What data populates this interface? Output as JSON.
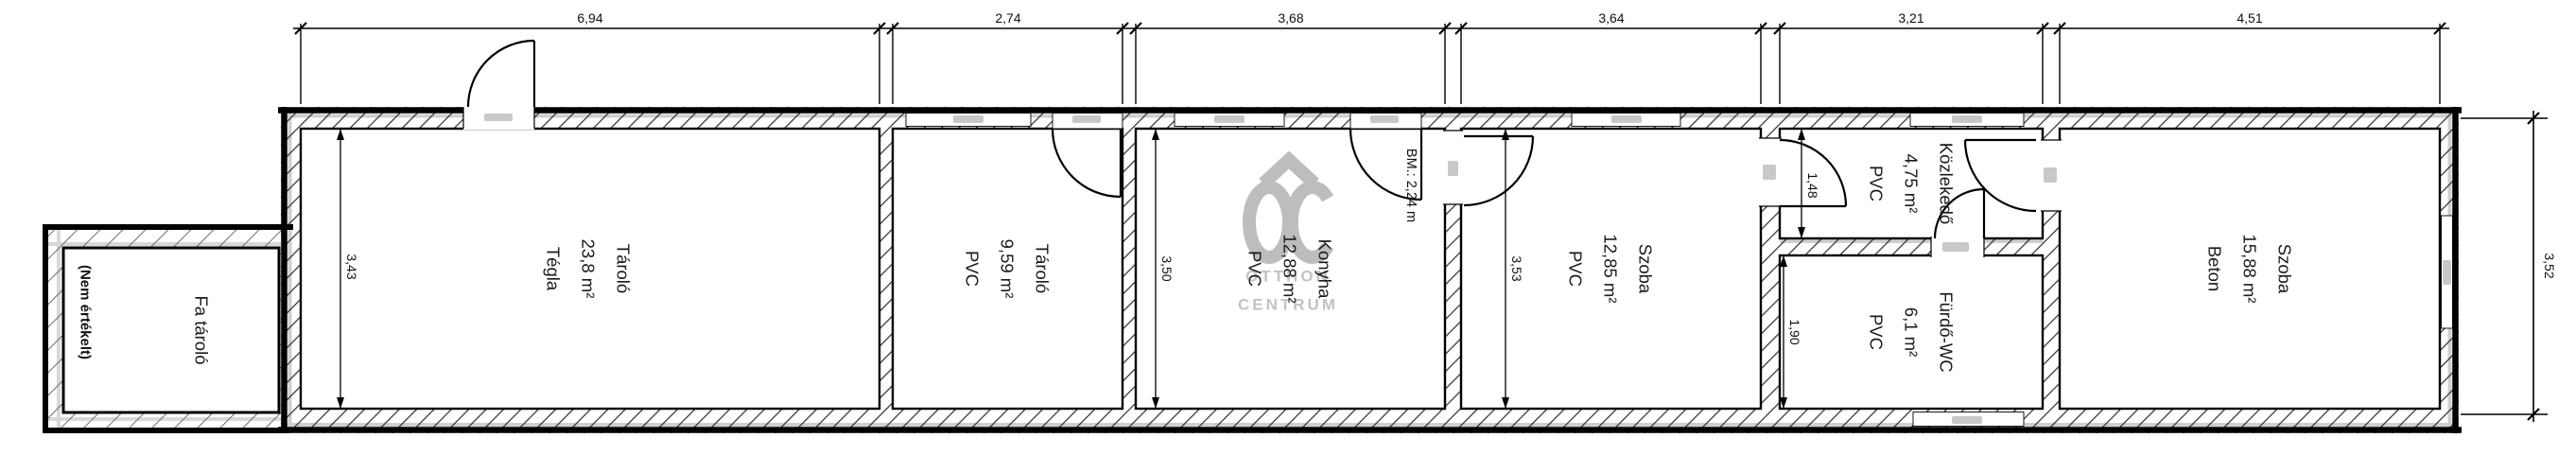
{
  "plan": {
    "watermark": {
      "line1": "OTTHON",
      "line2": "CENTRUM"
    },
    "rooms": [
      {
        "name": "Fa tároló",
        "lines": [
          "Fa tároló"
        ],
        "note": "(Nem értékelt)"
      },
      {
        "name": "Tároló",
        "lines": [
          "Tároló",
          "23,8 m²",
          "Tégla"
        ]
      },
      {
        "name": "Tároló",
        "lines": [
          "Tároló",
          "9,59 m²",
          "PVC"
        ]
      },
      {
        "name": "Konyha",
        "lines": [
          "Konyha",
          "12,88 m²",
          "PVC"
        ],
        "note": "BM.: 2,24 m"
      },
      {
        "name": "Szoba",
        "lines": [
          "Szoba",
          "12,85 m²",
          "PVC"
        ]
      },
      {
        "name": "Közlekedő",
        "lines": [
          "Közlekedő",
          "4,75 m²",
          "PVC"
        ]
      },
      {
        "name": "Fürdő-WC",
        "lines": [
          "Fürdő-WC",
          "6,1 m²",
          "PVC"
        ]
      },
      {
        "name": "Szoba",
        "lines": [
          "Szoba",
          "15,88 m²",
          "Beton"
        ]
      }
    ],
    "dimensions": {
      "top": [
        "6,94",
        "2,74",
        "3,68",
        "3,64",
        "3,21",
        "4,51"
      ],
      "right_height": "3,52",
      "interior": {
        "tarolo1_depth": "3,43",
        "konyha_depth": "3,50",
        "szoba1_depth": "3,53",
        "kozlekedo_depth": "1,48",
        "furdo_depth": "1,90"
      }
    },
    "colors": {
      "line": "#000000",
      "watermark": "#bdbdbd",
      "symbol": "#c8c8c8"
    }
  }
}
